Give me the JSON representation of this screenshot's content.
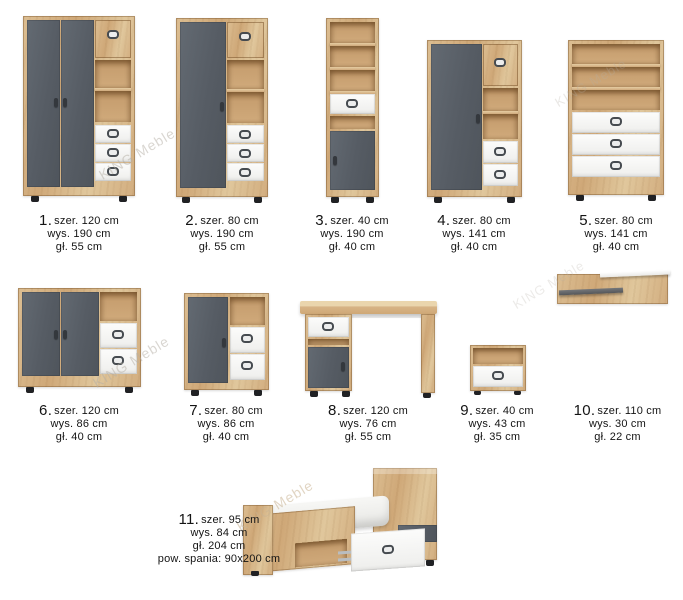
{
  "brand_watermark": "KING Meble",
  "colors": {
    "wood": "#d5b184",
    "graphite": "#5a6067",
    "white_front": "#f6f6f4",
    "feet_black": "#202124",
    "label_text": "#141414"
  },
  "products": [
    {
      "num": "1.",
      "type": "wardrobe-3-door",
      "dims": [
        "szer. 120 cm",
        "wys. 190 cm",
        "gł. 55 cm"
      ]
    },
    {
      "num": "2.",
      "type": "wardrobe-2-door",
      "dims": [
        "szer. 80 cm",
        "wys. 190 cm",
        "gł. 55 cm"
      ]
    },
    {
      "num": "3.",
      "type": "bookcase-tall-narrow",
      "dims": [
        "szer. 40 cm",
        "wys. 190 cm",
        "gł. 40 cm"
      ]
    },
    {
      "num": "4.",
      "type": "cabinet-medium",
      "dims": [
        "szer. 80 cm",
        "wys. 141 cm",
        "gł. 40 cm"
      ]
    },
    {
      "num": "5.",
      "type": "bookcase-with-drawers",
      "dims": [
        "szer. 80 cm",
        "wys. 141 cm",
        "gł. 40 cm"
      ]
    },
    {
      "num": "6.",
      "type": "sideboard-large",
      "dims": [
        "szer. 120 cm",
        "wys. 86 cm",
        "gł. 40 cm"
      ]
    },
    {
      "num": "7.",
      "type": "sideboard-small",
      "dims": [
        "szer. 80 cm",
        "wys. 86 cm",
        "gł. 40 cm"
      ]
    },
    {
      "num": "8.",
      "type": "desk",
      "dims": [
        "szer. 120 cm",
        "wys. 76 cm",
        "gł. 55 cm"
      ]
    },
    {
      "num": "9.",
      "type": "nightstand",
      "dims": [
        "szer. 40 cm",
        "wys. 43 cm",
        "gł. 35 cm"
      ]
    },
    {
      "num": "10.",
      "type": "wall-shelf",
      "dims": [
        "szer. 110 cm",
        "wys. 30 cm",
        "gł. 22 cm"
      ]
    },
    {
      "num": "11.",
      "type": "bed",
      "dims": [
        "szer. 95 cm",
        "wys. 84 cm",
        "gł. 204 cm",
        "pow. spania: 90x200 cm"
      ]
    }
  ]
}
